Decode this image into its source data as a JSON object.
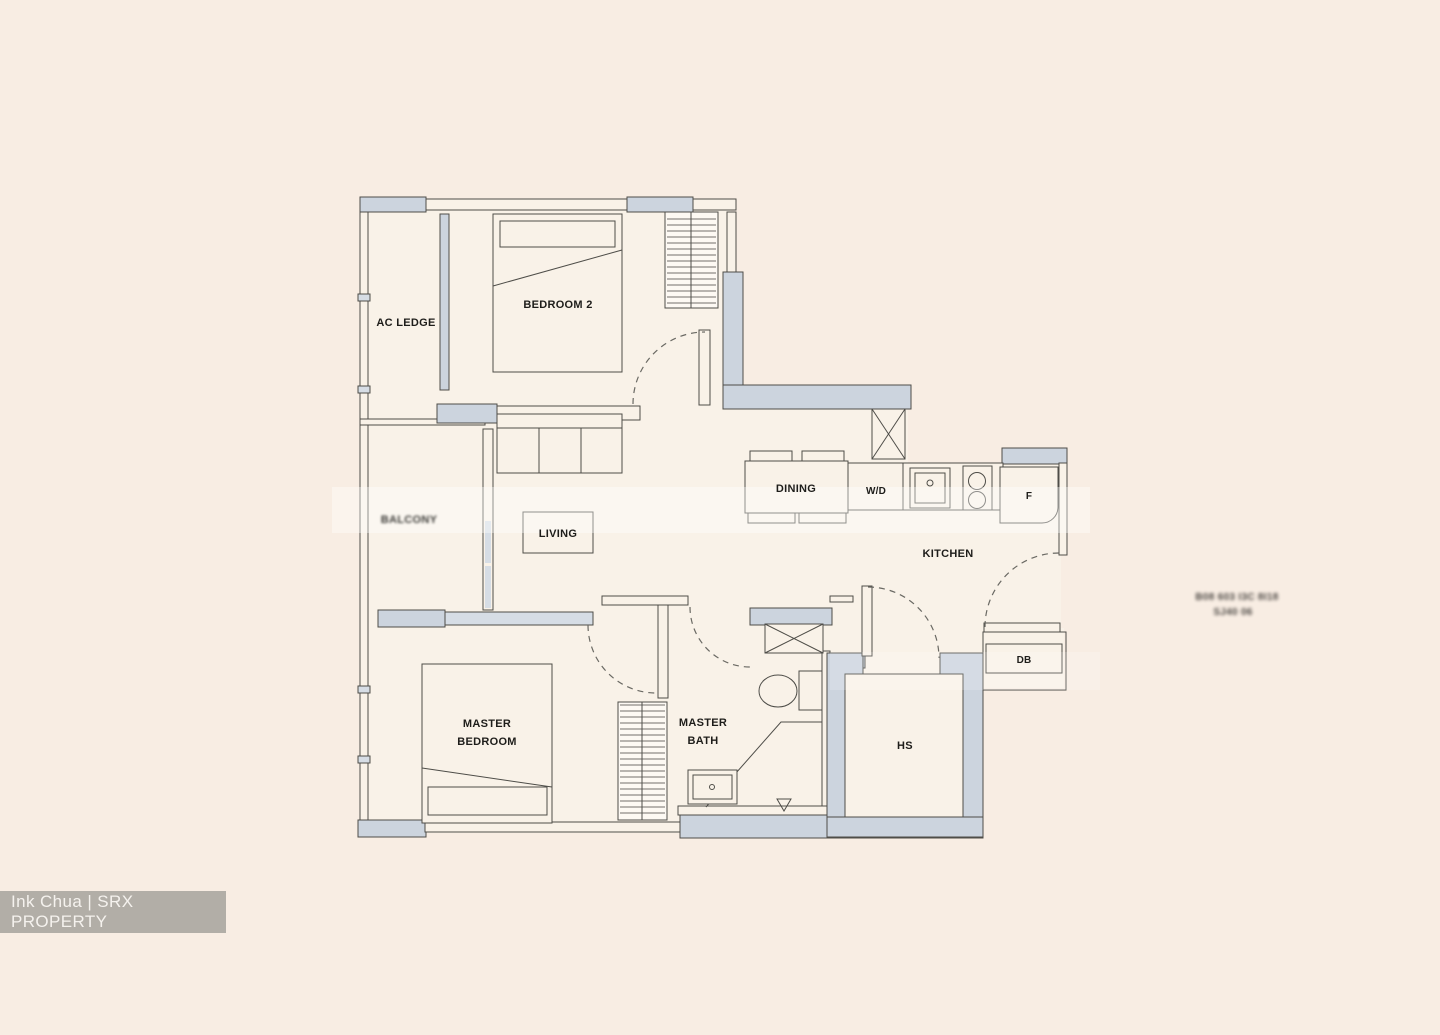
{
  "palette": {
    "page-bg": "#f8ede3",
    "floor": "#f9f2e8",
    "wall-fill": "#ccd4de",
    "wall-fill-light": "#d6dde5",
    "line": "#4e4d48",
    "label": "#1e1d1a",
    "watermark-bg": "#b2aea7",
    "watermark-text": "#f5f2ee"
  },
  "watermark": {
    "credit": "Ink Chua | SRX PROPERTY"
  },
  "labels": {
    "ac_ledge": "AC LEDGE",
    "bedroom2": "BEDROOM 2",
    "balcony_blurred": "BALCONY",
    "living": "LIVING",
    "dining": "DINING",
    "wd": "W/D",
    "kitchen": "KITCHEN",
    "fridge": "F",
    "db": "DB",
    "hs": "HS",
    "master_bedroom_line1": "MASTER",
    "master_bedroom_line2": "BEDROOM",
    "master_bath_line1": "MASTER",
    "master_bath_line2": "BATH",
    "unit_blur_line1": "B08 603 I3C 8I18",
    "unit_blur_line2": "SJ40 06"
  }
}
